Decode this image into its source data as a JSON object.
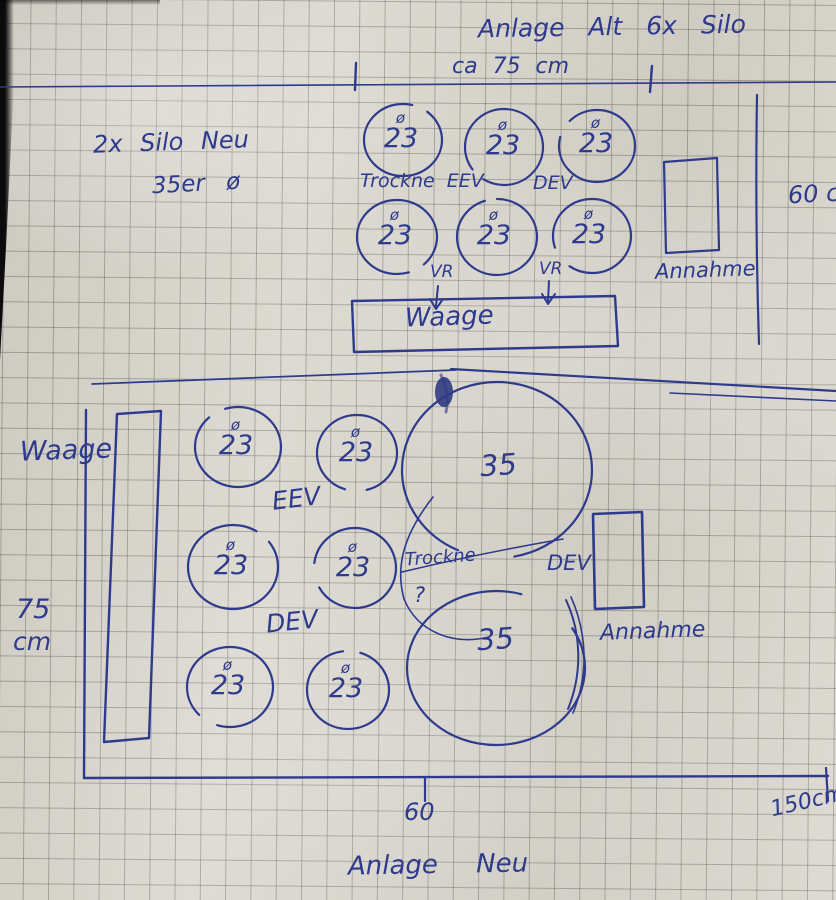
{
  "colors": {
    "ink": "#2e3a8c",
    "paper": "#d9d6cd"
  },
  "upper_plan": {
    "title": "Anlage Alt 6x Silo",
    "top_dimension": "ca 75 cm",
    "note_line1": "2x Silo Neu",
    "note_line2": "35er ø",
    "silos": [
      {
        "sym": "ø",
        "val": "23"
      },
      {
        "sym": "ø",
        "val": "23"
      },
      {
        "sym": "ø",
        "val": "23"
      },
      {
        "sym": "ø",
        "val": "23"
      },
      {
        "sym": "ø",
        "val": "23"
      },
      {
        "sym": "ø",
        "val": "23"
      }
    ],
    "dryer_label": "Trockne EEV",
    "dev_label": "DEV",
    "vr_left": "VR",
    "vr_right": "VR",
    "scale_label": "Waage",
    "intake_label": "Annahme",
    "right_dimension": "60 c"
  },
  "lower_plan": {
    "scale_label": "Waage",
    "left_dimension_value": "75",
    "left_dimension_unit": "cm",
    "eev_label": "EEV",
    "dev_label": "DEV",
    "silos": [
      {
        "sym": "ø",
        "val": "23"
      },
      {
        "sym": "ø",
        "val": "23"
      },
      {
        "sym": "ø",
        "val": "23"
      },
      {
        "sym": "ø",
        "val": "23"
      },
      {
        "sym": "ø",
        "val": "23"
      },
      {
        "sym": "ø",
        "val": "23"
      }
    ],
    "big_silos": [
      {
        "val": "35"
      },
      {
        "val": "35"
      }
    ],
    "dryer_label": "Trockne",
    "dryer_question": "?",
    "dev_box_label": "DEV",
    "intake_label": "Annahme",
    "bottom_dimension_mid": "60",
    "bottom_dimension_right": "150cm",
    "title": "Anlage Neu"
  }
}
